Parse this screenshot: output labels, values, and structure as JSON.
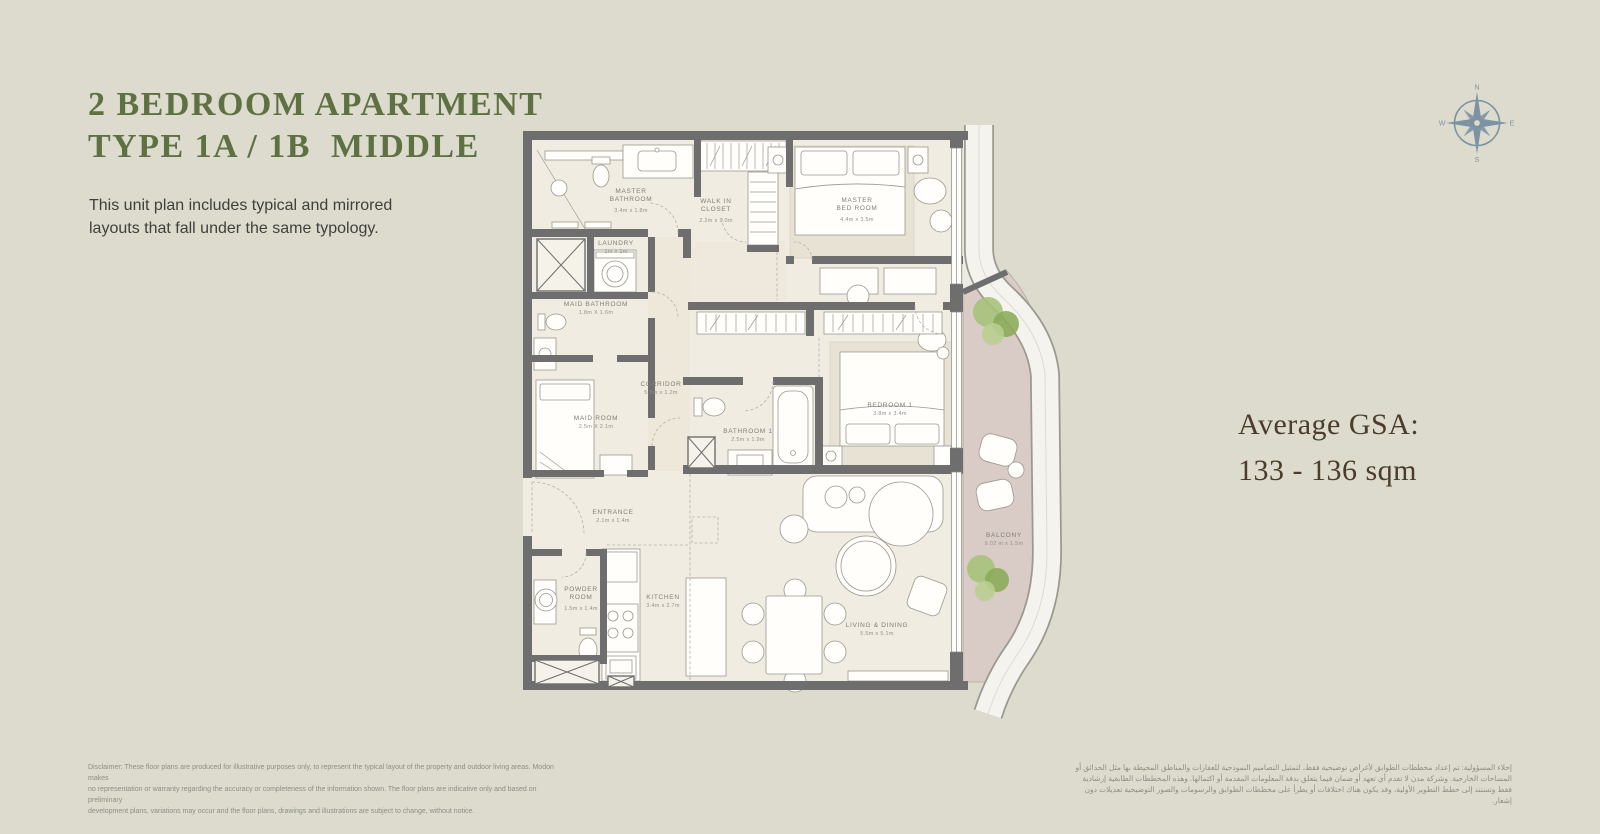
{
  "header": {
    "title_line1": "2 BEDROOM APARTMENT",
    "title_line2": "TYPE 1A / 1B  MIDDLE",
    "description_line1": "This unit plan includes typical and mirrored",
    "description_line2": "layouts that fall under the same typology.",
    "title_color": "#5f7142"
  },
  "compass": {
    "n": "N",
    "e": "E",
    "s": "S",
    "w": "W",
    "color": "#7d93a3"
  },
  "gsa": {
    "label": "Average GSA:",
    "value": "133 - 136 sqm",
    "color": "#4b3c2b"
  },
  "plan": {
    "colors": {
      "wall": "#6e6e6e",
      "floor": "#f1ece1",
      "balcony_floor": "#d9cbc5",
      "facade_band": "#f4f3ee",
      "rug": "#e8e2d4",
      "tree": "#8aab58"
    },
    "rooms": [
      {
        "name": "MASTER\nBATHROOM",
        "dims": "3.4m x 1.8m"
      },
      {
        "name": "WALK IN\nCLOSET",
        "dims": "2.2m x 1.0m"
      },
      {
        "name": "MASTER\nBED ROOM",
        "dims": "4.4m x 3.5m"
      },
      {
        "name": "LAUNDRY",
        "dims": "1m x 1m"
      },
      {
        "name": "MAID BATHROOM",
        "dims": "1.8m X 1.6m"
      },
      {
        "name": "CORRIDOR",
        "dims": "5.5m x 1.2m"
      },
      {
        "name": "MAID ROOM",
        "dims": "2.5m X 2.1m"
      },
      {
        "name": "BATHROOM 1",
        "dims": "2.5m x 1.9m"
      },
      {
        "name": "BEDROOM 1",
        "dims": "3.8m x 3.4m"
      },
      {
        "name": "ENTRANCE",
        "dims": "2.1m x 1.4m"
      },
      {
        "name": "POWDER\nROOM",
        "dims": "1.5m x 1.4m"
      },
      {
        "name": "KITCHEN",
        "dims": "3.4m x 2.7m"
      },
      {
        "name": "LIVING & DINING",
        "dims": "5.5m x 5.1m"
      },
      {
        "name": "BALCONY",
        "dims": "9.02 m x 1.5m"
      }
    ]
  },
  "footer": {
    "disclaimer_lines": [
      "Disclaimer: These floor plans are produced for illustrative purposes only, to represent the typical layout of the property and outdoor living areas.  Modon makes",
      "no representation or warranty regarding the accuracy or completeness of the information shown.  The floor plans are indicative only and based on preliminary",
      "development plans, variations may occur and the floor plans, drawings and illustrations are subject to change, without notice."
    ],
    "arabic_lines": [
      "إخلاء المسؤولية: تم إعداد مخططات الطوابق لأغراض توضيحية فقط، لتمثيل التصاميم النموذجية للعقارات والمناطق المحيطة بها مثل الحدائق أو",
      "المساحات الخارجية. وشركة مدن لا تقدم أي تعهد أو ضمان فيما يتعلق بدقة المعلومات المقدمة أو اكتمالها. وهذه المخططات الطابقية إرشادية",
      "فقط وتستند إلى خطط التطوير الأولية، وقد يكون هناك اختلافات أو يطرأ على مخططات الطوابق والرسومات والصور التوضيحية تعديلات دون إشعار."
    ]
  }
}
